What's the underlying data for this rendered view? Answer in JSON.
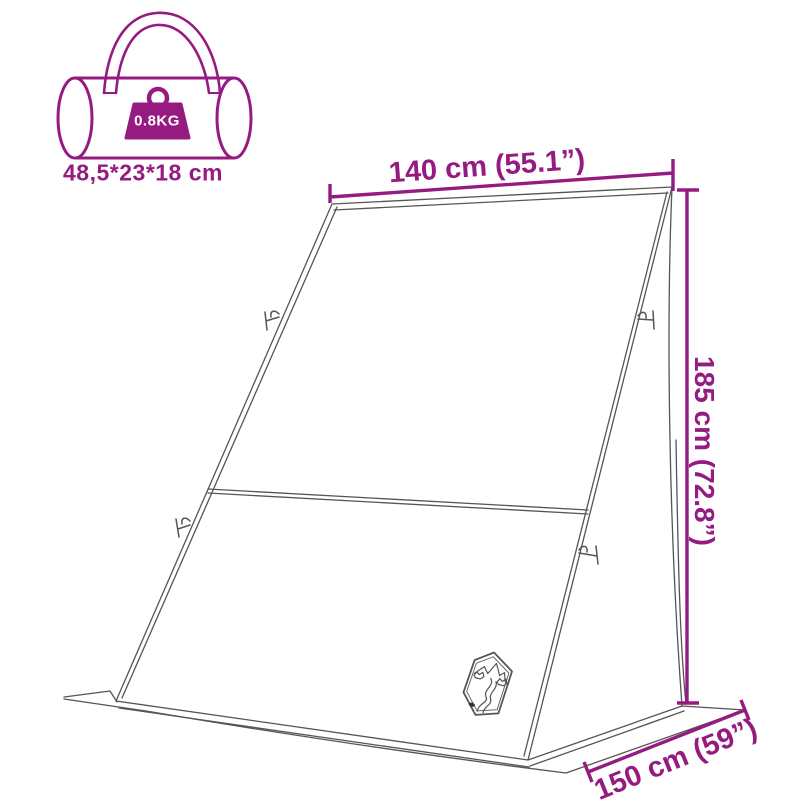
{
  "colors": {
    "accent_magenta": "#951b81",
    "drawing_line_gray": "#555555",
    "weight_label_text": "#ffffff",
    "background": "#ffffff"
  },
  "bag": {
    "icon_name": "carry-bag-icon",
    "weight_label": "0.8KG",
    "size_label": "48,5*23*18 cm"
  },
  "dimensions": {
    "width": {
      "label": "140 cm (55.1”)"
    },
    "height": {
      "label": "185 cm (72.8”)"
    },
    "depth": {
      "label": "150 cm (59”)"
    }
  },
  "drawing": {
    "subject_icon": "windscreen-tent-outline",
    "logo_icon": "mountain-trail-shield-logo"
  }
}
